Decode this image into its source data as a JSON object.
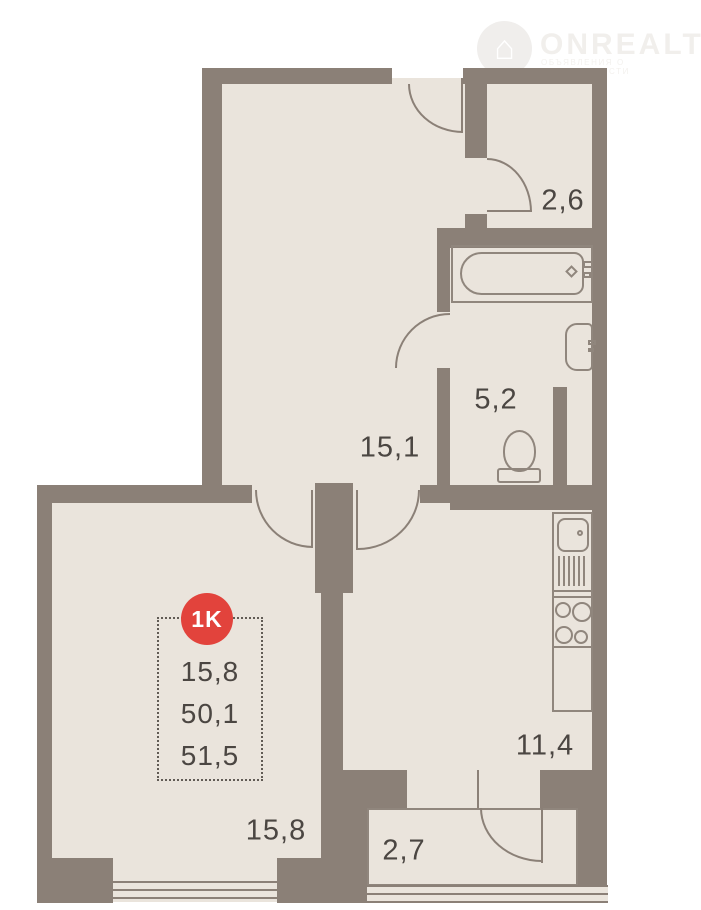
{
  "watermark": {
    "brand": "ONREALT",
    "subtitle": "ОБЪЯВЛЕНИЯ О НЕДВИЖИМОСТИ",
    "house_glyph": "⌂"
  },
  "plan": {
    "unit_badge": {
      "type_label": "1K",
      "areas": [
        "15,8",
        "50,1",
        "51,5"
      ]
    },
    "rooms": {
      "hallway": {
        "label": "15,1"
      },
      "wardrobe": {
        "label": "2,6"
      },
      "bathroom": {
        "label": "5,2"
      },
      "kitchen": {
        "label": "11,4"
      },
      "living_room": {
        "label": "15,8"
      },
      "balcony": {
        "label": "2,7"
      }
    },
    "colors": {
      "wall": "#8b8077",
      "floor": "#eae4dc",
      "badge_red": "#e2433c",
      "label_text": "#4b4642"
    }
  }
}
